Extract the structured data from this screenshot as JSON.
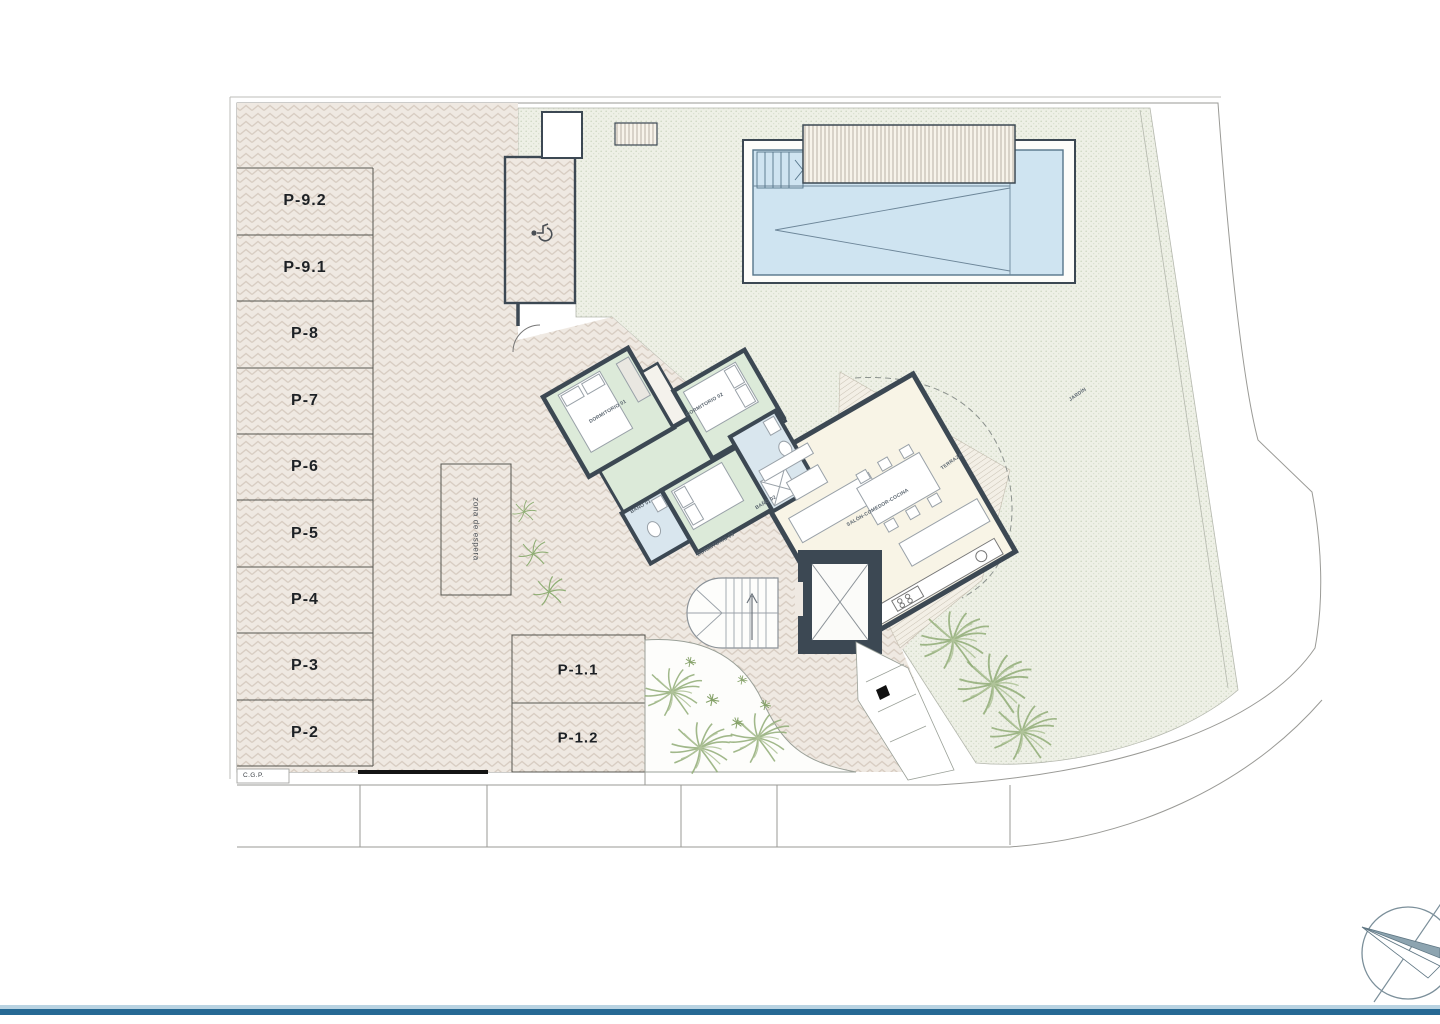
{
  "plan": {
    "title": "villa-site-plan",
    "parking": {
      "stalls": [
        {
          "label": "P-9.2"
        },
        {
          "label": "P-9.1"
        },
        {
          "label": "P-8"
        },
        {
          "label": "P-7"
        },
        {
          "label": "P-6"
        },
        {
          "label": "P-5"
        },
        {
          "label": "P-4"
        },
        {
          "label": "P-3"
        },
        {
          "label": "P-2"
        }
      ],
      "front": [
        {
          "label": "P-1.1"
        },
        {
          "label": "P-1.2"
        }
      ]
    },
    "annotations": {
      "waiting_zone": "zona de espera",
      "cgp": "C.G.P."
    },
    "house": {
      "rooms": [
        {
          "label": "DORMITORIO 01"
        },
        {
          "label": "DORMITORIO 02"
        },
        {
          "label": "DORMITORIO 03"
        },
        {
          "label": "BAÑO 01"
        },
        {
          "label": "BAÑO 02"
        },
        {
          "label": "SALÓN-COMEDOR-COCINA"
        },
        {
          "label": "TERRAZA"
        },
        {
          "label": "JARDÍN"
        }
      ]
    },
    "colors": {
      "pool_water": "#cfe4f1",
      "walls": "#3c4853",
      "bedroom": "#dcead9",
      "bathroom": "#d9e6ee",
      "living": "#f8f4e6",
      "paving": "#efe9e2",
      "garden": "#eef0e7",
      "bottom_bar": "#266994"
    }
  }
}
